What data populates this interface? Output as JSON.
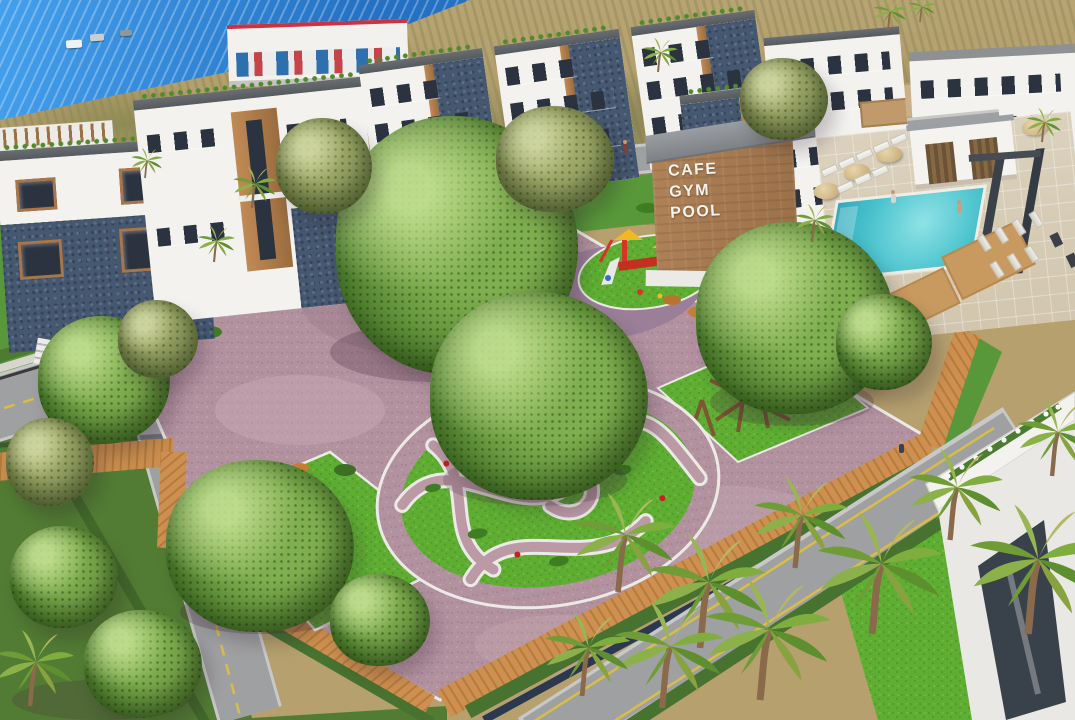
{
  "scene": {
    "description": "Aerial 3D rendering of a seaside residential complex: modern white villas with stone bases, a central landscaped park with curved garden paths, playgrounds, benches, palm-lined roads, a swimming pool deck and an amenity building",
    "sign": {
      "lines": [
        "CAFE",
        "GYM",
        "POOL"
      ]
    },
    "palette": {
      "sea": "#2f81d3",
      "scrubland": "#b3a06e",
      "villa_white": "#f3f2ef",
      "stone_blue": "#46586f",
      "wood_trim": "#b07b4a",
      "roof_gray": "#5e6266",
      "gravel_mauve": "#b392a0",
      "boardwalk_tan": "#cd9050",
      "lawn_green": "#5fae33",
      "hedge_green": "#477230",
      "road_gray": "#9fa0a2",
      "road_line_yellow": "#d9bd45",
      "pool_turquoise": "#3fc0ca",
      "cafe_wall_brick": "#a87c55",
      "playground_red": "#d63426",
      "playground_yellow": "#f2b824",
      "slide_blue": "#2f6fd0",
      "rubber_purple": "#9b7e98"
    }
  }
}
